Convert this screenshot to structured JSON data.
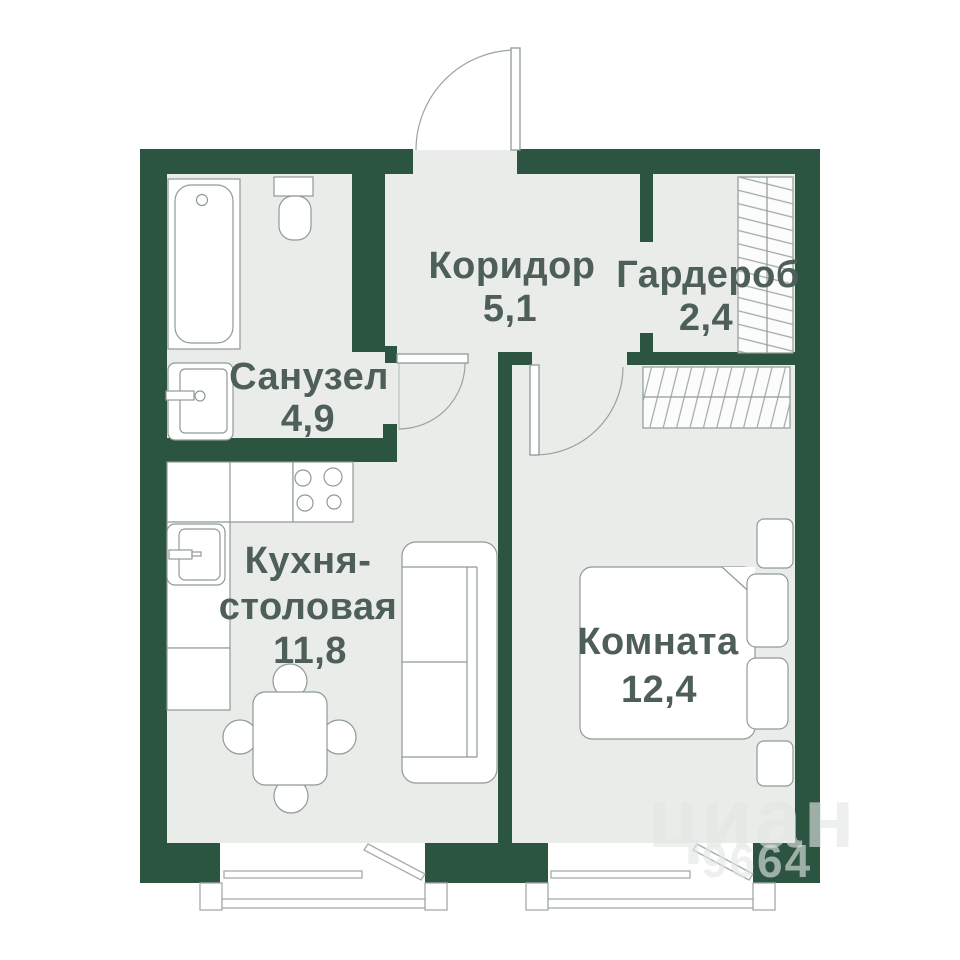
{
  "colors": {
    "wall_green": "#2b5441",
    "floor_gray": "#e9ece9",
    "label_color": "#4e5e58",
    "furniture_outline": "#8f9a96"
  },
  "rooms": {
    "corridor": {
      "label": "Коридор",
      "area": "5,1"
    },
    "wardrobe": {
      "label": "Гардероб",
      "area": "2,4"
    },
    "bathroom": {
      "label": "Санузел",
      "area": "4,9"
    },
    "kitchen_dining": {
      "label_line1": "Кухня-",
      "label_line2": "столовая",
      "area": "11,8"
    },
    "room": {
      "label": "Комната",
      "area": "12,4"
    }
  },
  "watermark": {
    "brand": "циан",
    "number": "9664"
  }
}
